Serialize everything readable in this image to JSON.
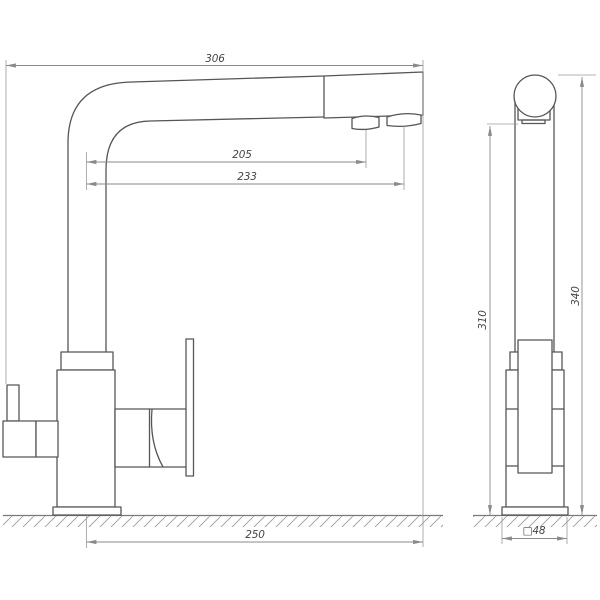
{
  "drawing": {
    "kind": "faucet-technical-drawing",
    "dimensions": {
      "overall_width": "306",
      "filtered_outlet_reach": "205",
      "aerator_reach": "233",
      "spout_projection": "250",
      "aerator_height": "310",
      "overall_height": "340",
      "base_size": "□48"
    },
    "colors": {
      "background": "#ffffff",
      "outline": "#565656",
      "dimension_line": "#8a8a8a",
      "dimension_text": "#454545",
      "hatching": "#9a9a9a"
    }
  }
}
